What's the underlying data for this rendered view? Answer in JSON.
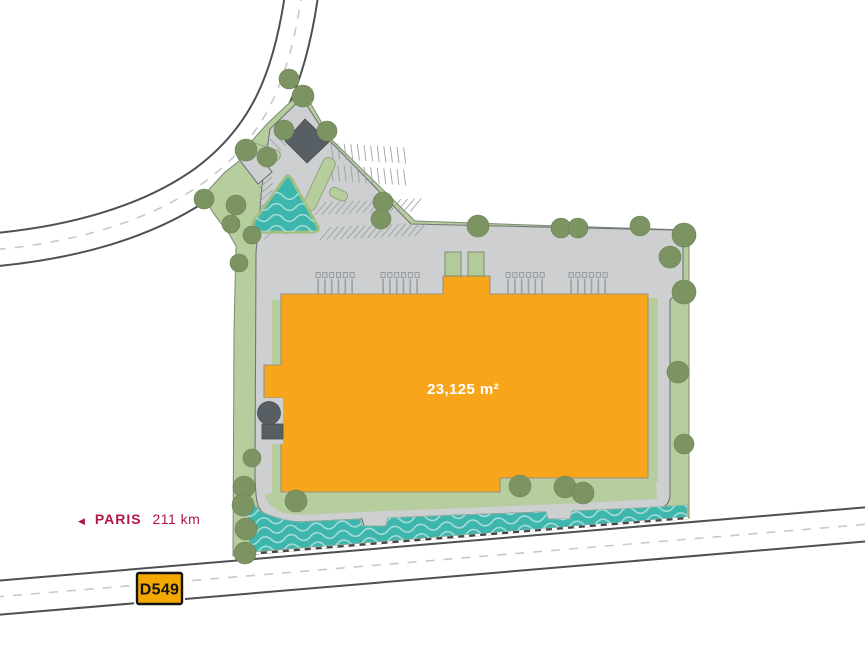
{
  "map": {
    "name": "logistics-site-plan",
    "building": {
      "area_label": "23,125 m²",
      "fill": "#F7A61B"
    },
    "direction_sign": {
      "arrow": "◀",
      "city": "PARIS",
      "distance": "211 km",
      "color": "#B21743"
    },
    "road_badge": {
      "label": "D549",
      "fill": "#F3A900",
      "border": "#141414"
    },
    "palette": {
      "landscape": "#B6CD9E",
      "pavement": "#CDCFD0",
      "water": "#3DB6AE",
      "water_wave": "#A7DCD6",
      "tree": "#7C9462",
      "tree_edge": "#6b8053",
      "dark_structure": "#585F64",
      "road_casing": "#4E5052",
      "road_fill": "#FFFFFF"
    }
  }
}
